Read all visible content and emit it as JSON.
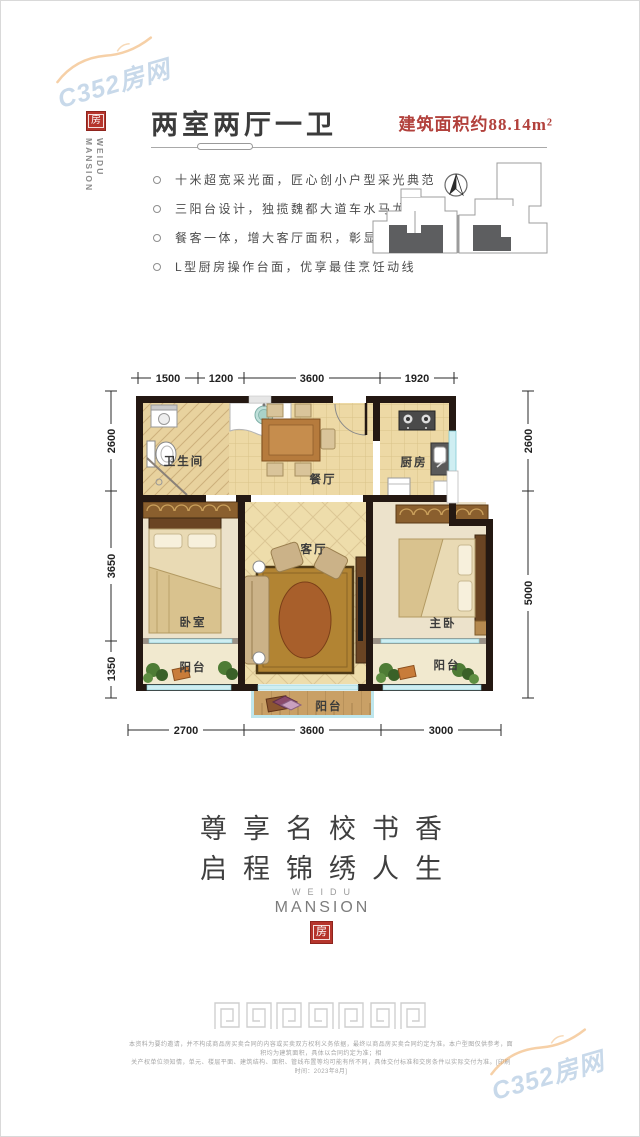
{
  "watermark": {
    "text": "C352房网"
  },
  "logo": {
    "seal_char": "房",
    "brand_vertical": "WEIDU MANSION"
  },
  "header": {
    "title": "两室两厅一卫",
    "area_label": "建筑面积约88.14m²",
    "accent_color": "#b2413c"
  },
  "features": [
    "十米超宽采光面，匠心创小户型采光典范",
    "三阳台设计，独揽魏都大道车水马龙",
    "餐客一体，增大客厅面积，彰显主人气势",
    "L型厨房操作台面，优享最佳烹饪动线"
  ],
  "plan": {
    "dims_top": [
      "1500",
      "1200",
      "3600",
      "1920"
    ],
    "dims_bottom": [
      "2700",
      "3600",
      "3000"
    ],
    "dims_left": [
      "2600",
      "3650",
      "1350"
    ],
    "dims_right": [
      "2600",
      "5000"
    ],
    "rooms": {
      "bathroom": "卫生间",
      "dining": "餐厅",
      "kitchen": "厨房",
      "living": "客厅",
      "bedroom": "卧室",
      "master": "主卧",
      "balcony": "阳台"
    }
  },
  "slogan": {
    "line1": "尊享名校书香",
    "line2": "启程锦绣人生"
  },
  "brand": {
    "line1": "WEIDU",
    "line2": "MANSION",
    "seal_char": "房"
  },
  "disclaimer": {
    "line1": "本资料为要约邀请，并不构成商品房买卖合同的内容或买卖双方权利义务依据，最终以商品房买卖合同约定为准。本户型图仅供参考，面积均为建筑面积，具体以合同约定为准；相",
    "line2": "关产权单位须知情，单元、楼层平面、建筑结构、面积、管线布置等均可能有所不同，具体交付标准和交房条件以实际交付为准。[印刷时间：2023年8月]"
  }
}
